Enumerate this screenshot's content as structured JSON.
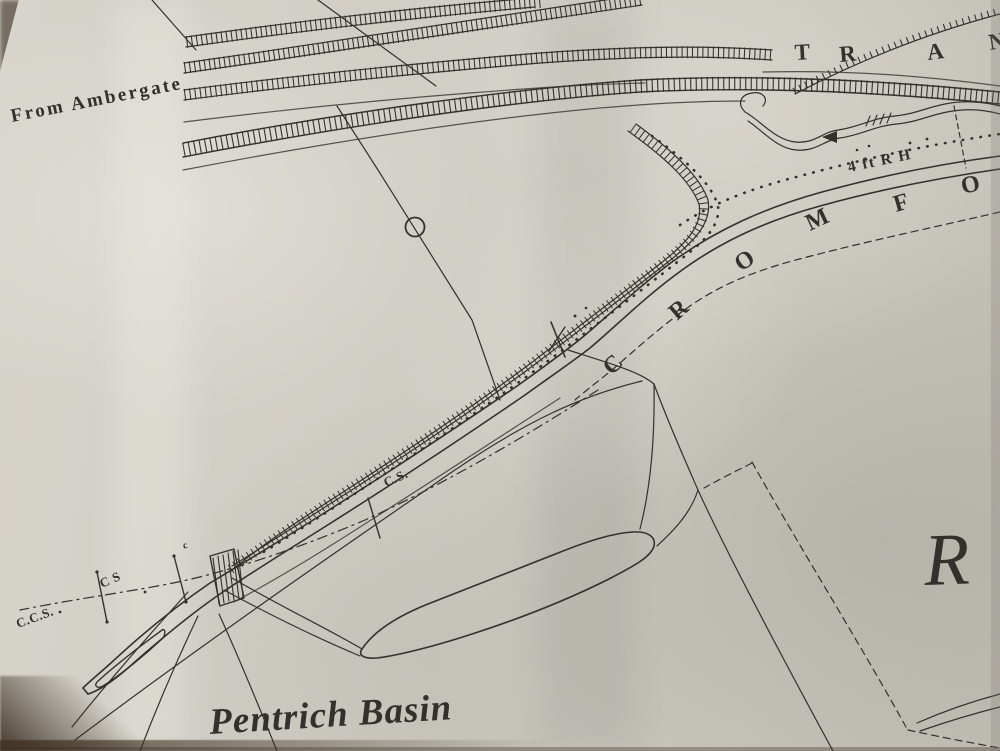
{
  "map": {
    "labels": {
      "from_ambergate": "From Ambergate",
      "tramway": {
        "letters": [
          "T",
          "R",
          "A",
          "N"
        ]
      },
      "gauge_note": "4 ft R H",
      "cromford": {
        "letters": [
          "C",
          "R",
          "O",
          "M",
          "F",
          "O"
        ]
      },
      "cross_section_1": "C.S.",
      "cross_section_2": "C S",
      "cross_section_3": "C.C.S.",
      "basin_name": "Pentrich Basin",
      "partial_big_letter": "R",
      "small_mark": "c"
    },
    "colors": {
      "ink": "#34312c",
      "ink_faded": "#55524b",
      "paper": "#cfccc4",
      "paper_light": "#d6d3cb",
      "paper_dark": "#b9b6ad",
      "edge_dark": "#4a4033"
    }
  }
}
